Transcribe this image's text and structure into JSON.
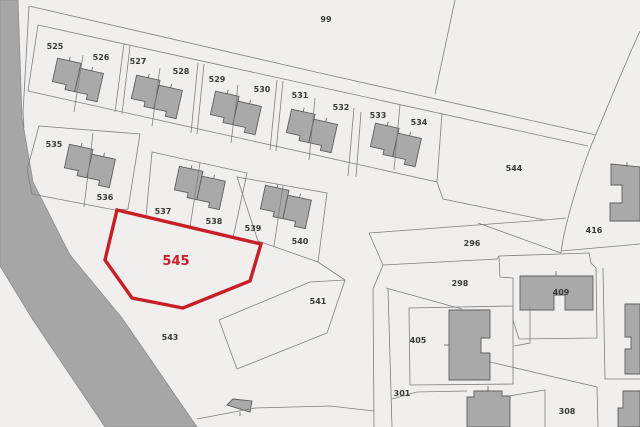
{
  "map": {
    "width": 640,
    "height": 427,
    "colors": {
      "background": "#f0efee",
      "parcel_line": "#7f7f7f",
      "road_fill": "#a6a6a6",
      "road_edge": "#8d8d8d",
      "building_fill": "#a9a9a9",
      "building_stroke": "#5e5e5e",
      "label": "#3a3a3a",
      "highlight": "#c81f26"
    },
    "highlight_parcel": {
      "label": "545",
      "points": "117,210 261,244 250,281 183,308 132,298 105,260",
      "label_x": 176,
      "label_y": 265,
      "font_size": 13
    },
    "road_points": "0,0 18,0 22,118 33,182 70,255 122,318 197,427 105,427 33,320 0,266",
    "boundaries": [
      "M29,6 L320,73 L596,135",
      "M38,25 L320,87 L588,146",
      "M455,0 L435,94",
      "M640,31 C620,75 603,118 591,146 C583,166 564,224 561,253",
      "M29,6 L23,113 L24,128",
      "M38,25 L28,91",
      "M28,91 L437,182 L443,199 L545,220",
      "M369,233 L545,220 L566,218",
      "M478,223 L561,253",
      "M369,233 L383,265 L373,289 L374,427",
      "M383,265 L497,259 L499,256",
      "M386,288 L462,309",
      "M499,256 L589,253 L591,263 L596,268 L597,338 L519,339 L513,320 L513,278 L500,277 Z",
      "M409,308 L513,306 L513,384 L410,385 Z",
      "M561,251 L640,244",
      "M388,289 L392,427",
      "M392,399 L417,392 L467,391",
      "M509,396 L545,390 L545,427",
      "M490,362 L597,387 L598,427",
      "M603,268 L605,379 L640,379",
      "M197,419 L255,408 L330,406 L374,411",
      "M530,307 L530,343 L514,346",
      "M124,44 L115,112",
      "M130,46 L122,114",
      "M198,63 L191,133",
      "M204,64 L197,134",
      "M277,80 L270,150",
      "M283,81 L276,151",
      "M354,108 L348,176",
      "M361,112 L356,177",
      "M442,113 L437,182",
      "M83,55 L74,112",
      "M160,68 L152,126",
      "M238,85 L231,143",
      "M315,98 L309,160",
      "M400,105 L394,170",
      "M39,126 L140,134 L128,209 L115,210 L32,194 L27,170 Z",
      "M93,133 L84,207",
      "M152,152 L247,173 L233,238 L146,217 Z",
      "M200,163 L190,227",
      "M237,177 L327,193 L318,262 L258,241 Z",
      "M283,186 L274,246",
      "M219,320 L310,282 L345,280 L327,333 L237,369 Z",
      "M318,262 L345,280"
    ],
    "duplex": {
      "left_path": "M-24,-14 L0,-14 L0,15 L-10,15 L-10,10 L-24,10 Z",
      "right_path": "M0,-9 L24,-9 L24,20 L13,20 L13,15 L0,15 Z",
      "tick1": "M-12,-14 L-12,-18",
      "tick2": "M12,-9 L12,-13",
      "placements": [
        {
          "cx": 78,
          "cy": 77,
          "rot": 12.5
        },
        {
          "cx": 157,
          "cy": 94,
          "rot": 12.5
        },
        {
          "cx": 236,
          "cy": 110,
          "rot": 12.5
        },
        {
          "cx": 312,
          "cy": 128,
          "rot": 12.5
        },
        {
          "cx": 396,
          "cy": 142,
          "rot": 12.5
        },
        {
          "cx": 90,
          "cy": 163,
          "rot": 12
        },
        {
          "cx": 200,
          "cy": 185,
          "rot": 12
        },
        {
          "cx": 286,
          "cy": 204,
          "rot": 12
        }
      ]
    },
    "building_shapes": [
      {
        "name": "building-right-top",
        "path": "M611,164 L640,167 L640,221 L610,221 L610,203 L622,203 L622,185 L611,185 Z"
      },
      {
        "name": "building-409",
        "path": "M520,276 L593,276 L593,310 L565,310 L565,295 L554,295 L554,310 L520,310 Z"
      },
      {
        "name": "building-405",
        "path": "M449,310 L490,310 L490,338 L481,338 L481,353 L490,353 L490,380 L449,380 Z"
      },
      {
        "name": "building-301",
        "path": "M467,397 L474,397 L474,391 L502,391 L502,396 L510,396 L510,427 L467,427 Z"
      },
      {
        "name": "building-308",
        "path": "M623,391 L640,391 L640,427 L618,427 L618,408 L623,408 Z"
      },
      {
        "name": "building-right-mid",
        "path": "M625,304 L640,304 L640,374 L625,374 L625,349 L631,349 L631,337 L625,337 Z"
      },
      {
        "name": "building-road-shed",
        "path": "M227,405 L233,399 L252,401 L250,412 Z"
      }
    ],
    "ticks": [
      "M556,276 L556,271",
      "M449,345 L444,345",
      "M488,391 L488,386",
      "M627,167 L627,162",
      "M240,412 L240,416"
    ],
    "labels": [
      {
        "text": "99",
        "x": 326,
        "y": 22
      },
      {
        "text": "525",
        "x": 55,
        "y": 49
      },
      {
        "text": "526",
        "x": 101,
        "y": 60
      },
      {
        "text": "527",
        "x": 138,
        "y": 64
      },
      {
        "text": "528",
        "x": 181,
        "y": 74
      },
      {
        "text": "529",
        "x": 217,
        "y": 82
      },
      {
        "text": "530",
        "x": 262,
        "y": 92
      },
      {
        "text": "531",
        "x": 300,
        "y": 98
      },
      {
        "text": "532",
        "x": 341,
        "y": 110
      },
      {
        "text": "533",
        "x": 378,
        "y": 118
      },
      {
        "text": "534",
        "x": 419,
        "y": 125
      },
      {
        "text": "535",
        "x": 54,
        "y": 147
      },
      {
        "text": "536",
        "x": 105,
        "y": 200
      },
      {
        "text": "537",
        "x": 163,
        "y": 214
      },
      {
        "text": "538",
        "x": 214,
        "y": 224
      },
      {
        "text": "539",
        "x": 253,
        "y": 231
      },
      {
        "text": "540",
        "x": 300,
        "y": 244
      },
      {
        "text": "541",
        "x": 318,
        "y": 304
      },
      {
        "text": "543",
        "x": 170,
        "y": 340
      },
      {
        "text": "544",
        "x": 514,
        "y": 171
      },
      {
        "text": "296",
        "x": 472,
        "y": 246
      },
      {
        "text": "298",
        "x": 460,
        "y": 286
      },
      {
        "text": "301",
        "x": 402,
        "y": 396
      },
      {
        "text": "308",
        "x": 567,
        "y": 414
      },
      {
        "text": "405",
        "x": 418,
        "y": 343
      },
      {
        "text": "409",
        "x": 561,
        "y": 295
      },
      {
        "text": "416",
        "x": 594,
        "y": 233
      }
    ]
  }
}
